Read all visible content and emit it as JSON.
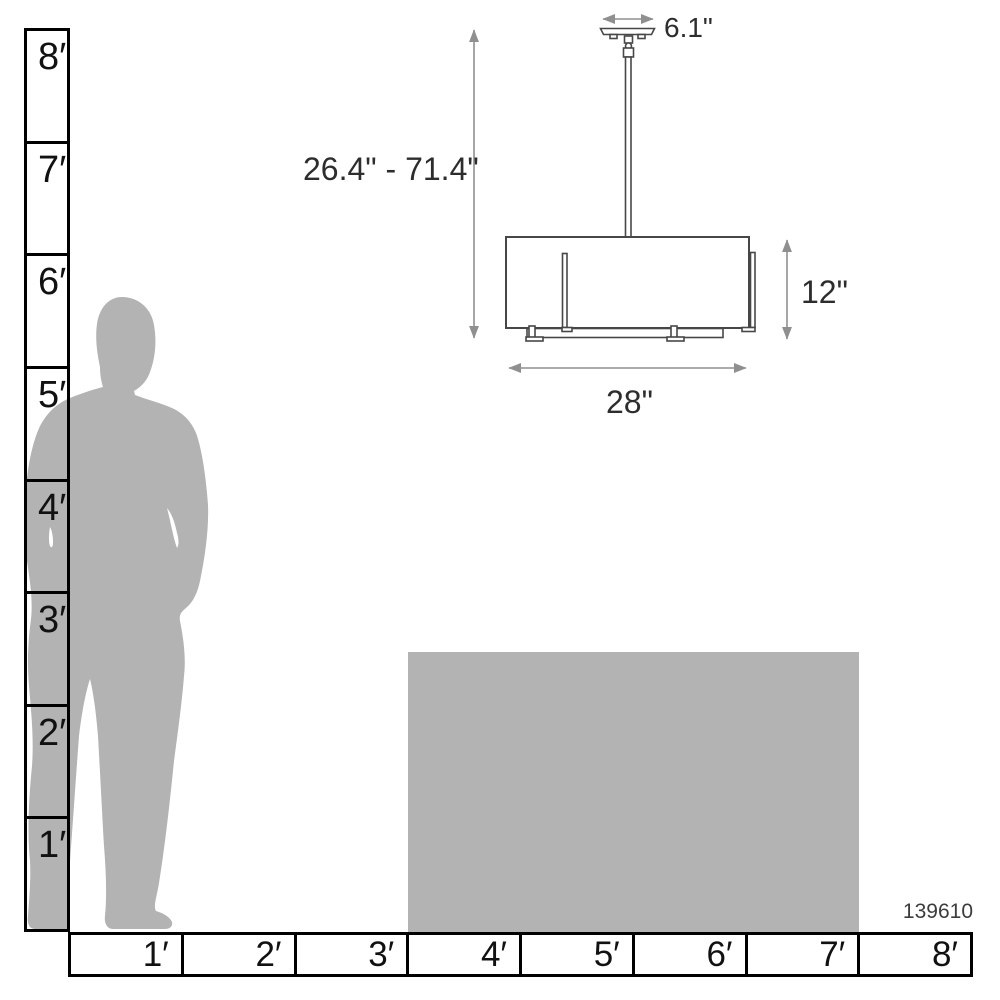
{
  "figure": {
    "sku": "139610",
    "description": "Pendant light fixture scale dimension diagram"
  },
  "colors": {
    "gray_fill": "#b3b3b3",
    "ruler_line": "#000000",
    "fixture_line": "#474747",
    "dimension_line": "#8f8f8f",
    "dimension_text": "#2d2d2d"
  },
  "left_ruler": {
    "unit": "feet",
    "labels": [
      "8′",
      "7′",
      "6′",
      "5′",
      "4′",
      "3′",
      "2′",
      "1′"
    ]
  },
  "bottom_ruler": {
    "unit": "feet",
    "labels": [
      "1′",
      "2′",
      "3′",
      "4′",
      "5′",
      "6′",
      "7′",
      "8′"
    ]
  },
  "dimensions": {
    "canopy_width": "6.1\"",
    "hanging_height_range": "26.4\" - 71.4\"",
    "shade_height": "12\"",
    "shade_width": "28\""
  }
}
